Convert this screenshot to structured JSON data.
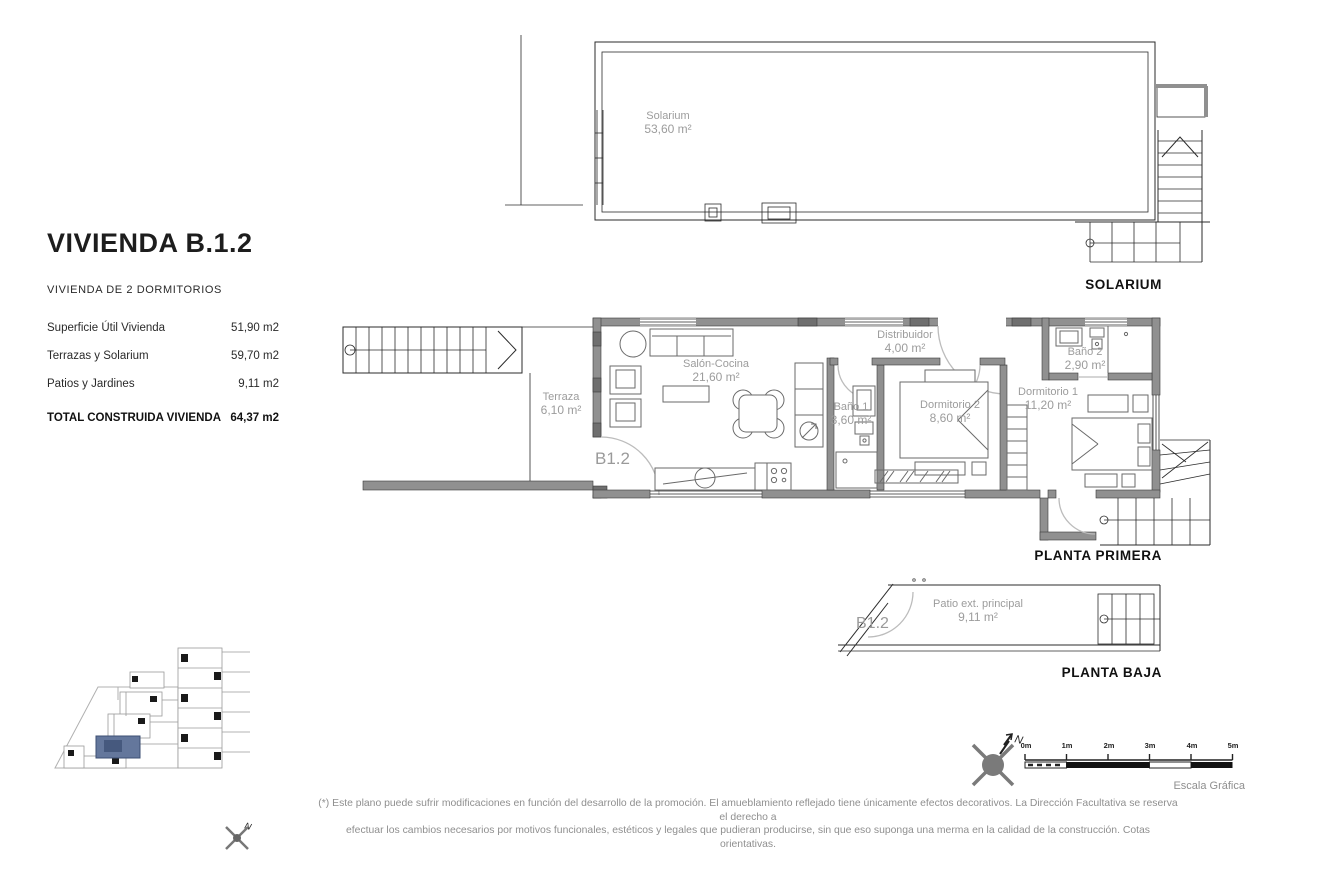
{
  "info_panel": {
    "title": "VIVIENDA B.1.2",
    "subtitle": "VIVIENDA DE 2 DORMITORIOS",
    "rows": [
      {
        "label": "Superficie Útil Vivienda",
        "value": "51,90 m2"
      },
      {
        "label": "Terrazas y Solarium",
        "value": "59,70 m2"
      },
      {
        "label": "Patios y Jardines",
        "value": "9,11 m2"
      }
    ],
    "total": {
      "label": "TOTAL CONSTRUIDA VIVIENDA",
      "value": "64,37 m2"
    }
  },
  "solarium_plan": {
    "room": {
      "name": "Solarium",
      "area": "53,60 m²"
    },
    "caption": "SOLARIUM"
  },
  "planta_primera": {
    "caption": "PLANTA PRIMERA",
    "unit_label": "B1.2",
    "rooms": [
      {
        "name": "Terraza",
        "area": "6,10 m²"
      },
      {
        "name": "Salón-Cocina",
        "area": "21,60 m²"
      },
      {
        "name": "Baño 1",
        "area": "3,60 m²"
      },
      {
        "name": "Distribuidor",
        "area": "4,00 m²"
      },
      {
        "name": "Dormitorio 2",
        "area": "8,60 m²"
      },
      {
        "name": "Baño 2",
        "area": "2,90 m²"
      },
      {
        "name": "Dormitorio 1",
        "area": "11,20 m²"
      }
    ]
  },
  "planta_baja": {
    "caption": "PLANTA BAJA",
    "unit_label": "B1.2",
    "rooms": [
      {
        "name": "Patio ext. principal",
        "area": "9,11 m²"
      }
    ]
  },
  "compass": {
    "north_label": "N"
  },
  "site_plan": {
    "north_label": "N"
  },
  "scale_bar": {
    "ticks": [
      "0m",
      "1m",
      "2m",
      "3m",
      "4m",
      "5m"
    ],
    "caption": "Escala Gráfica"
  },
  "disclaimer": {
    "line1": "(*) Este plano puede sufrir modificaciones en función del desarrollo de la promoción. El amueblamiento reflejado tiene únicamente efectos decorativos. La Dirección Facultativa se reserva el derecho a",
    "line2": "efectuar los cambios necesarios por motivos funcionales, estéticos y legales que pudieran producirse, sin que eso suponga una merma en la calidad de la construcción. Cotas orientativas."
  },
  "colors": {
    "wall_gray": "#909090",
    "pillar_gray": "#6f6f6f",
    "label_gray": "#9c9c9c",
    "highlight_blue": "#64779c",
    "line_black": "#2b2b2b"
  }
}
